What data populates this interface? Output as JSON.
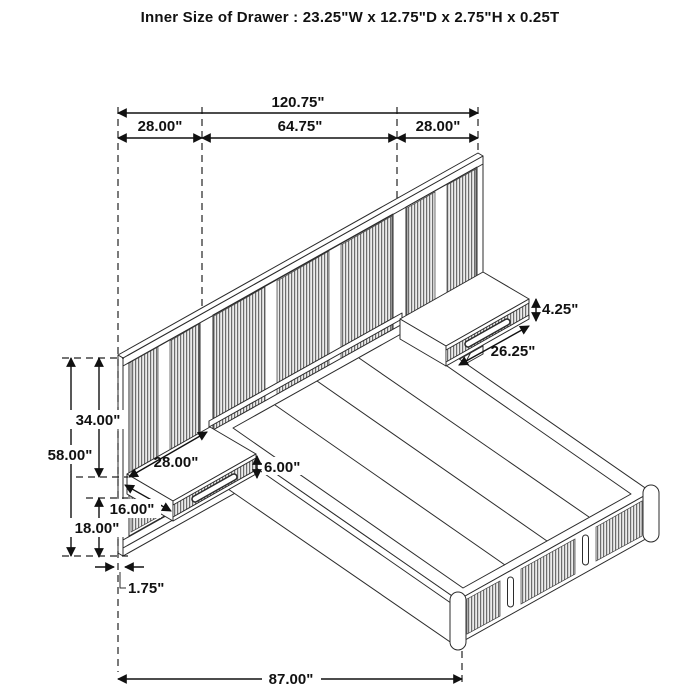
{
  "title": "Inner Size of Drawer : 23.25\"W x 12.75\"D x 2.75\"H x 0.25T",
  "dimensions": {
    "overall_width": "120.75\"",
    "left_panel_width": "28.00\"",
    "center_panel_width": "64.75\"",
    "right_panel_width": "28.00\"",
    "panel_height": "58.00\"",
    "top_to_nightstand": "34.00\"",
    "nightstand_to_floor": "18.00\"",
    "panel_thickness": "1.75\"",
    "left_nightstand_width": "28.00\"",
    "left_nightstand_depth": "16.00\"",
    "left_nightstand_height": "6.00\"",
    "right_nightstand_width": "26.25\"",
    "right_nightstand_height": "4.25\"",
    "bed_length": "87.00\""
  }
}
